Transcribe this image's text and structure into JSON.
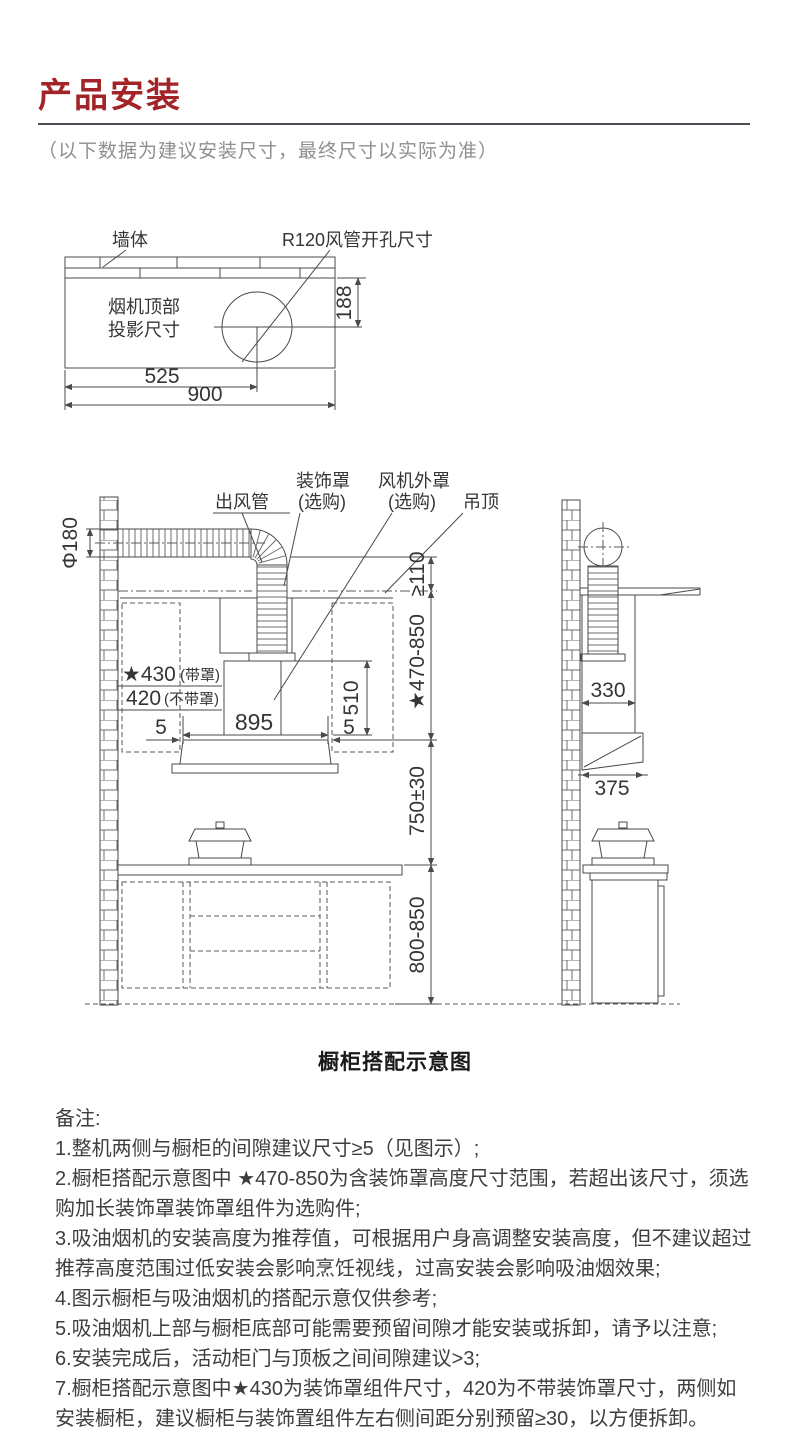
{
  "colors": {
    "accent_red": "#a32428",
    "line": "#4a4a4a",
    "text": "#3e3e3e",
    "muted": "#8f8f8f"
  },
  "header": {
    "title": "产品安装",
    "subtitle": "（以下数据为建议安装尺寸，最终尺寸以实际为准）"
  },
  "top_diagram": {
    "labels": {
      "wall": "墙体",
      "duct_hole": "R120风管开孔尺寸",
      "projection_line1": "烟机顶部",
      "projection_line2": "投影尺寸"
    },
    "dims": {
      "hole_offset_y": "188",
      "hole_offset_x": "525",
      "total_width": "900"
    }
  },
  "front_view": {
    "labels": {
      "outlet_pipe": "出风管",
      "deco_cover": "装饰罩",
      "deco_cover_note": "(选购)",
      "fan_cover": "风机外罩",
      "fan_cover_note": "(选购)",
      "ceiling": "吊顶"
    },
    "dims": {
      "duct_diameter": "Φ180",
      "ceiling_gap": "≥110",
      "cover_height_range": "★470-850",
      "depth_with_cover": "★430",
      "depth_with_cover_note": "(带罩)",
      "depth_without_cover": "420",
      "depth_without_cover_note": "(不带罩)",
      "hood_width": "895",
      "side_gap_left": "5",
      "side_gap_right": "5",
      "chimney_height": "510",
      "hood_to_counter": "750±30",
      "counter_height": "800-850"
    }
  },
  "side_view": {
    "dims": {
      "chimney_depth": "330",
      "hood_depth": "375"
    }
  },
  "caption": "橱柜搭配示意图",
  "notes": {
    "heading": "备注:",
    "items": [
      "1.整机两侧与橱柜的间隙建议尺寸≥5（见图示）;",
      "2.橱柜搭配示意图中 ★470-850为含装饰罩高度尺寸范围，若超出该尺寸，须选购加长装饰罩装饰罩组件为选购件;",
      "3.吸油烟机的安装高度为推荐值，可根据用户身高调整安装高度，但不建议超过推荐高度范围过低安装会影响烹饪视线，过高安装会影响吸油烟效果;",
      "4.图示橱柜与吸油烟机的搭配示意仅供参考;",
      "5.吸油烟机上部与橱柜底部可能需要预留间隙才能安装或拆卸，请予以注意;",
      "6.安装完成后，活动柜门与顶板之间间隙建议>3;",
      "7.橱柜搭配示意图中★430为装饰罩组件尺寸，420为不带装饰罩尺寸，两侧如安装橱柜，建议橱柜与装饰置组件左右侧间距分别预留≥30，以方便拆卸。"
    ]
  }
}
